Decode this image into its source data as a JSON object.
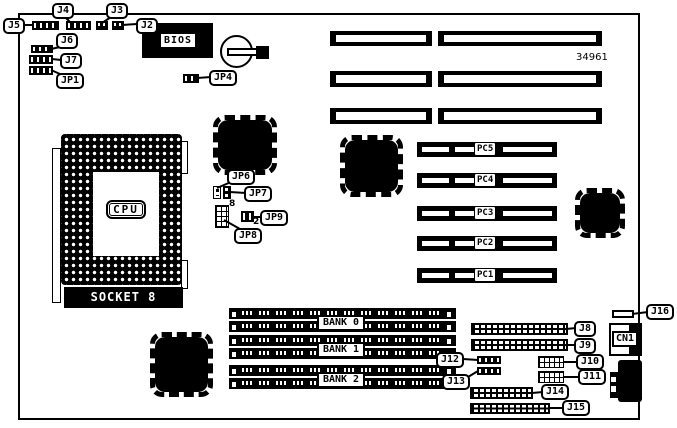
{
  "part_number": "34961",
  "chips": {
    "bios": "BIOS",
    "cpu": "CPU",
    "socket": "SOCKET 8",
    "cn1": "CN1"
  },
  "labels": {
    "j2": "J2",
    "j3": "J3",
    "j4": "J4",
    "j5": "J5",
    "j6": "J6",
    "j7": "J7",
    "jp1": "JP1",
    "jp4": "JP4",
    "jp6": "JP6",
    "jp7": "JP7",
    "jp8": "JP8",
    "jp9": "JP9",
    "j8": "J8",
    "j9": "J9",
    "j10": "J10",
    "j11": "J11",
    "j12": "J12",
    "j13": "J13",
    "j14": "J14",
    "j15": "J15",
    "j16": "J16"
  },
  "pin_counts": {
    "jp8": "8",
    "jp9": "2"
  },
  "pci_slots": [
    "PC5",
    "PC4",
    "PC3",
    "PC2",
    "PC1"
  ],
  "memory_banks": [
    "BANK 0",
    "BANK 1",
    "BANK 2"
  ]
}
